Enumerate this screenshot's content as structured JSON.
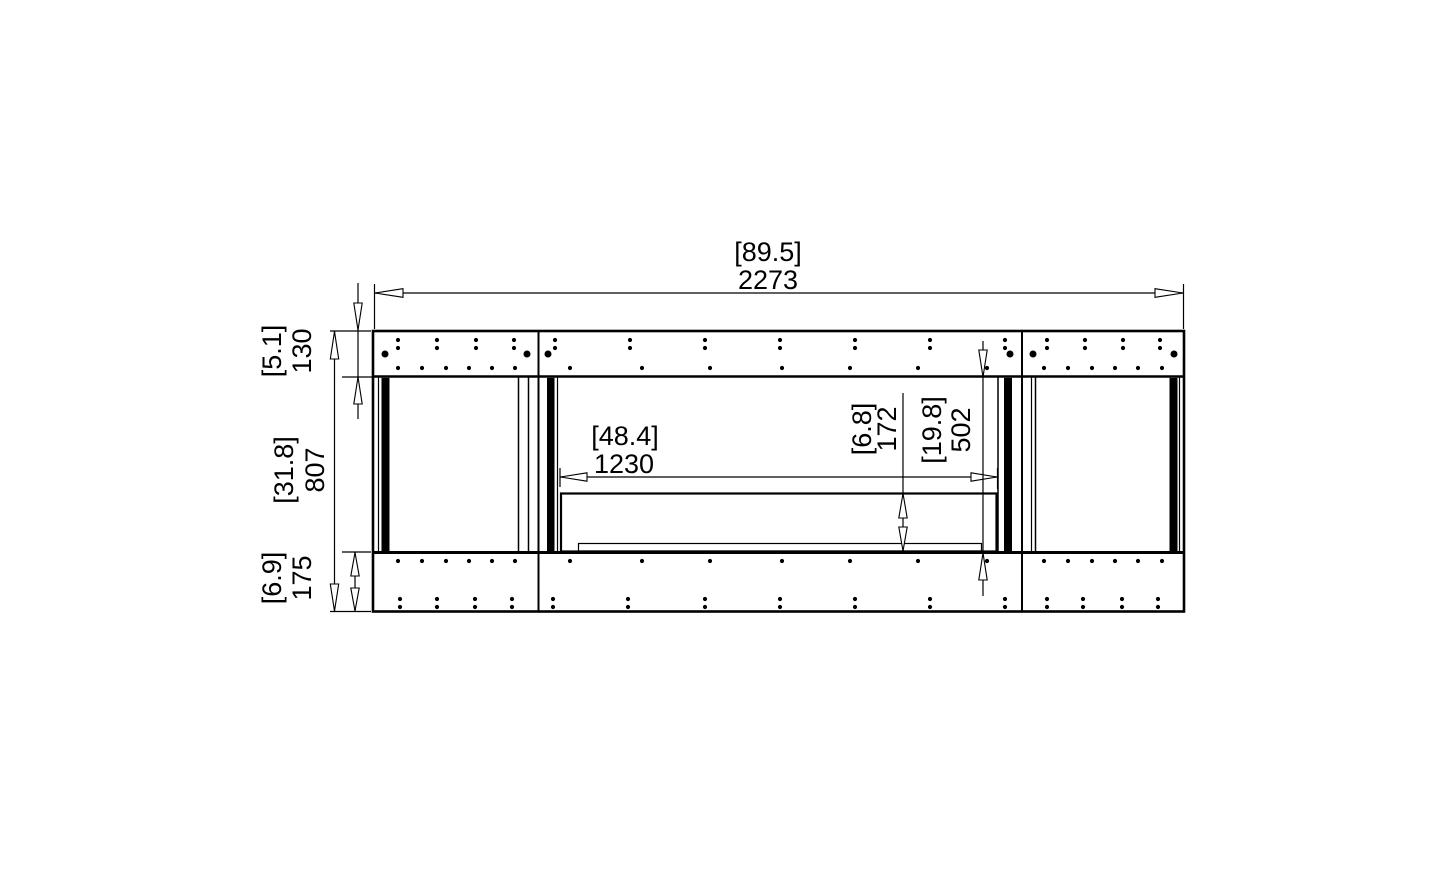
{
  "dimensions": {
    "overall_width": {
      "inches": "[89.5]",
      "mm": "2273"
    },
    "frame_top_height": {
      "inches": "[5.1]",
      "mm": "130"
    },
    "overall_height": {
      "inches": "[31.8]",
      "mm": "807"
    },
    "frame_bottom_height": {
      "inches": "[6.9]",
      "mm": "175"
    },
    "burner_width": {
      "inches": "[48.4]",
      "mm": "1230"
    },
    "burner_height": {
      "inches": "[6.8]",
      "mm": "172"
    },
    "opening_height": {
      "inches": "[19.8]",
      "mm": "502"
    }
  },
  "colors": {
    "line": "#000000",
    "background": "#ffffff"
  }
}
